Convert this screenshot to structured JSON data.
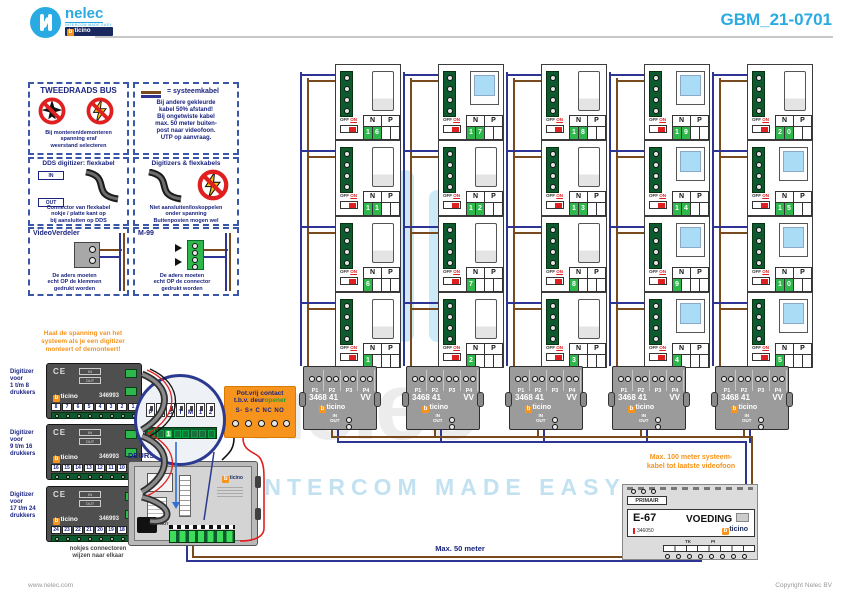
{
  "header": {
    "brand": "nelec",
    "brand_sub": "INTERCOM MADE EASY",
    "brand_bar": "bticino",
    "title": "GBM_21-0701"
  },
  "footer": {
    "left": "www.nelec.com",
    "right": "Copyright Nelec BV"
  },
  "watermark": {
    "word": "nelec",
    "tagline": "INTERCOM MADE EASY"
  },
  "info_boxes": {
    "bus": {
      "title": "TWEEDRAADS BUS",
      "caption": [
        "Bij monteren/demonteren",
        "spanning eraf",
        "weerstand selecteren"
      ]
    },
    "cable": {
      "legend": "= systeemkabel",
      "lines": [
        "Bij andere gekleurde",
        "kabel 50% afstand!",
        "Bij ongetwiste kabel",
        "max. 50 meter buiten-",
        "post naar videofoon.",
        "UTP op aanvraag."
      ]
    },
    "dds": {
      "title": "DDS digitizer: flexkabel",
      "in_label": "IN",
      "out_label": "OUT",
      "caption": [
        "Connector van flexkabel",
        "nokje / platte kant op",
        "bij aansluiten op DDS"
      ]
    },
    "digi": {
      "title": "Digitizers & flexkabels",
      "caption": [
        "Niet aansluiten/loskoppelen",
        "onder spanning",
        "Buitenposten mogen wel"
      ]
    },
    "verdeler": {
      "title": "VideoVerdeler",
      "caption": [
        "De aders moeten",
        "echt OP de klemmen",
        "gedrukt worden"
      ]
    },
    "m99": {
      "title": "M-99",
      "caption": [
        "De aders moeten",
        "echt OP de connector",
        "gedrukt worden"
      ]
    }
  },
  "orange_note": [
    "Haal de spanning van het",
    "systeem als je een digitizer",
    "monteert of demonteert!"
  ],
  "digitizers": {
    "ce": "CE",
    "in": "IN",
    "out": "OUT",
    "brand": "bticino",
    "modules": [
      {
        "label": [
          "Digitizer",
          "voor",
          "1 t/m 8",
          "drukkers"
        ],
        "model": "346993",
        "slots": [
          "8",
          "7",
          "6",
          "5",
          "4",
          "3",
          "2",
          "1"
        ]
      },
      {
        "label": [
          "Digitizer",
          "voor",
          "9 t/m 16",
          "drukkers"
        ],
        "model": "346993",
        "slots": [
          "16",
          "15",
          "14",
          "13",
          "12",
          "11",
          "10",
          "9"
        ]
      },
      {
        "label": [
          "Digitizer",
          "voor",
          "17 t/m 24",
          "drukkers"
        ],
        "model": "346993",
        "slots": [
          "24",
          "23",
          "22",
          "21",
          "20",
          "19",
          "18",
          "17"
        ]
      }
    ],
    "note": [
      "nokjes connectoren",
      "wijzen naar elkaar"
    ]
  },
  "inset": {
    "terminals": [
      "P",
      "N",
      "S",
      "T",
      "M",
      "1",
      "2"
    ],
    "jumper": "1"
  },
  "door_station": {
    "label": "DEURSTATION S-139V",
    "brand": "bticino",
    "in": "IN",
    "out": "OUT"
  },
  "contact": {
    "title": "Pot.vrij contact",
    "sub_prefix": "t.b.v. ",
    "sub_dark": "deur",
    "sub_green": "opener",
    "terminals": "S-  S+ C NC NO"
  },
  "riser": {
    "n_label": "N",
    "p_label": "P",
    "off": "OFF",
    "on": "ON",
    "units": [
      {
        "n": "16",
        "video": false
      },
      {
        "n": "17",
        "video": true
      },
      {
        "n": "18",
        "video": false
      },
      {
        "n": "19",
        "video": true
      },
      {
        "n": "20",
        "video": false
      },
      {
        "n": "11",
        "video": false
      },
      {
        "n": "12",
        "video": false
      },
      {
        "n": "13",
        "video": false
      },
      {
        "n": "14",
        "video": true
      },
      {
        "n": "15",
        "video": true
      },
      {
        "n": "6",
        "video": false
      },
      {
        "n": "7",
        "video": false
      },
      {
        "n": "8",
        "video": false
      },
      {
        "n": "9",
        "video": true
      },
      {
        "n": "10",
        "video": true
      },
      {
        "n": "1",
        "video": false
      },
      {
        "n": "2",
        "video": false
      },
      {
        "n": "3",
        "video": false
      },
      {
        "n": "4",
        "video": true
      },
      {
        "n": "5",
        "video": true
      }
    ]
  },
  "distributor": {
    "model": "3468 41",
    "grade": "VV",
    "brand": "bticino",
    "ports": [
      "P1",
      "P2",
      "P3",
      "P4"
    ],
    "in": "IN",
    "out": "OUT"
  },
  "psu": {
    "primair": "PRIMAIR",
    "model": "E-67",
    "part": "346050",
    "name": "VOEDING",
    "brand": "bticino",
    "t1": "TK",
    "t2": "PI"
  },
  "notes": {
    "max100": [
      "Max. 100 meter systeem-",
      "kabel tot laatste videofoon"
    ],
    "max50": "Max. 50 meter"
  },
  "colors": {
    "accent": "#2aaae2",
    "orange": "#f7941d",
    "navy": "#1b2580",
    "wire_blue": "#2d3494",
    "wire_brown": "#7a4a1f",
    "green": "#2eb84c",
    "dark_green": "#0d5a2e",
    "red": "#e02020"
  }
}
